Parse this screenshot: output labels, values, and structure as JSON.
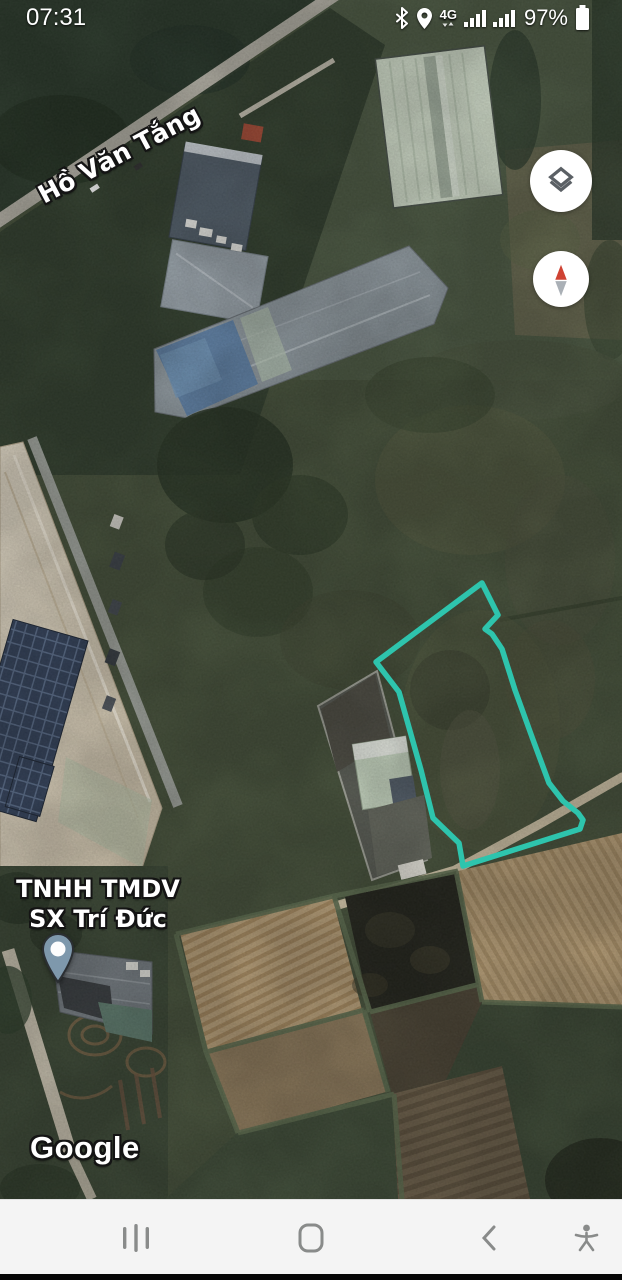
{
  "status_bar": {
    "time": "07:31",
    "network": "4G",
    "battery": "97%",
    "icons": [
      "bluetooth-icon",
      "location-icon",
      "mobile-data-4g-icon",
      "signal-strength-icon",
      "signal-strength-icon",
      "battery-icon"
    ]
  },
  "map": {
    "road_label": "Hồ Văn Tắng",
    "place_label": {
      "line1": "TNHH TMDV",
      "line2": "SX Trí Đức"
    },
    "attribution": "Google",
    "parcel_outline": {
      "color": "#2ec4ad",
      "points": "482,583 498,615 485,629 492,634 502,649 515,690 532,737 549,783 563,801 578,813 583,820 580,829 463,866 459,843 433,818 421,770 399,692 376,662 482,583"
    },
    "pin_color": "#7e98ac"
  },
  "map_controls": {
    "buttons": [
      "layers-button",
      "compass-button"
    ]
  },
  "nav_bar": {
    "buttons": [
      "recent-apps-button",
      "home-button",
      "back-button",
      "accessibility-button"
    ]
  }
}
